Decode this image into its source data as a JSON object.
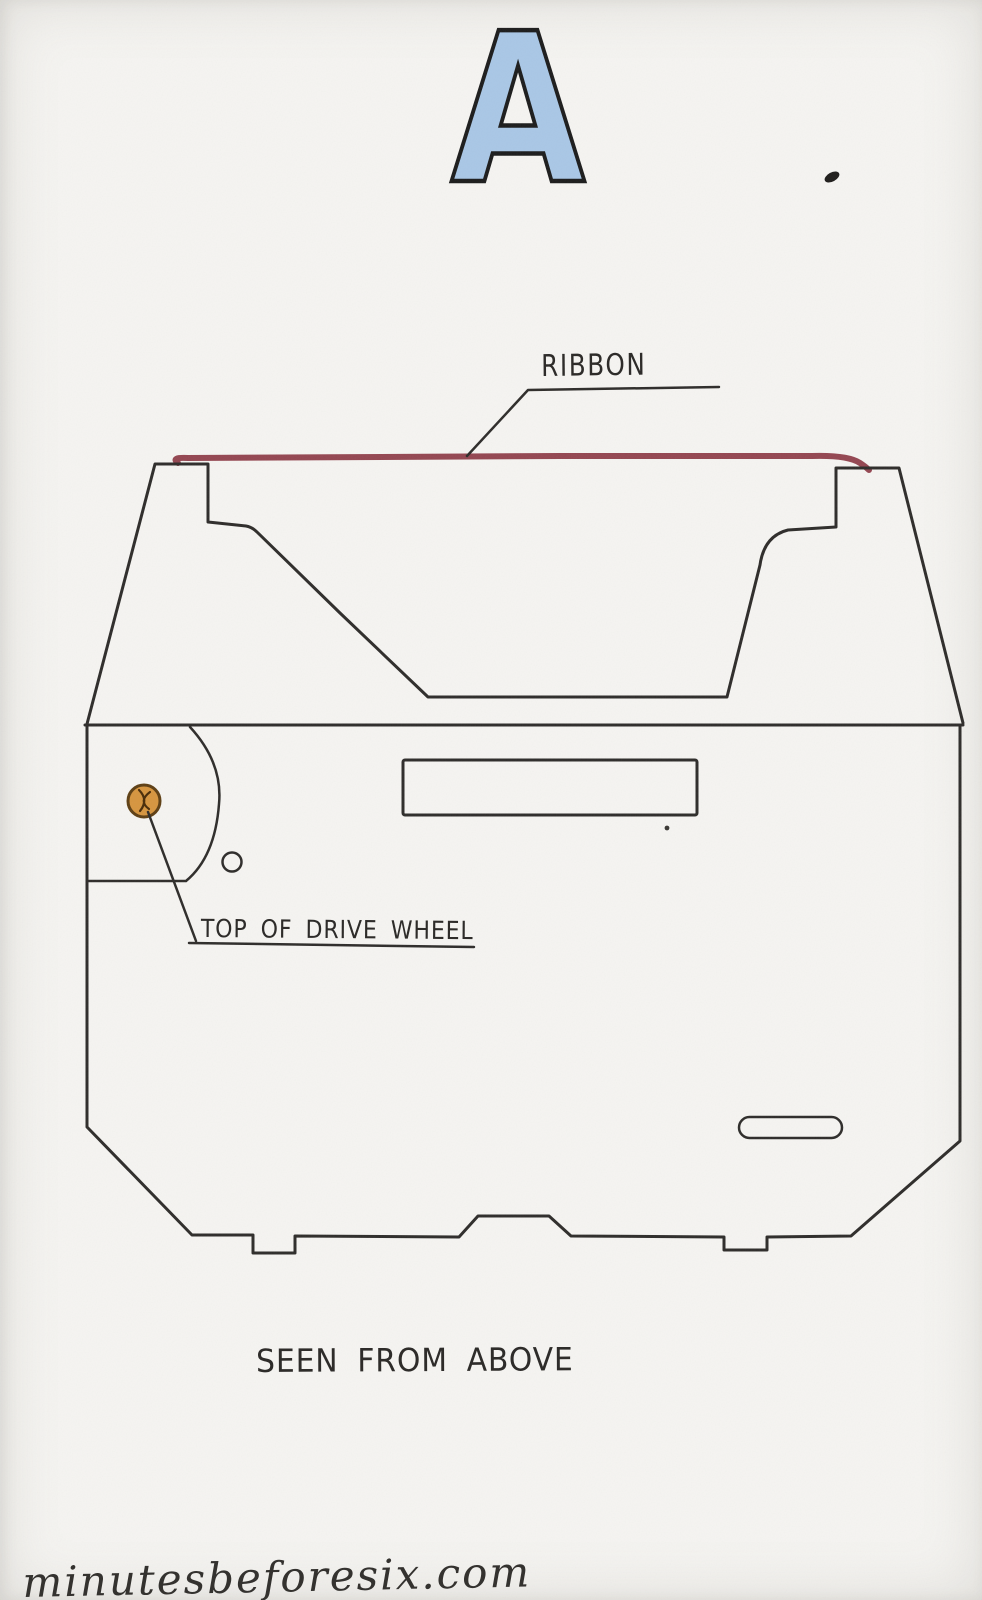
{
  "figure": {
    "letter": "A"
  },
  "annotations": {
    "ribbon_label": "RIBBON",
    "drive_wheel_label": "TOP OF DRIVE WHEEL",
    "caption": "SEEN FROM ABOVE",
    "watermark": "minutesbeforesix.com"
  },
  "diagram": {
    "type": "hand-drawn sketch",
    "subject": "typewriter ribbon cartridge, top view",
    "parts": [
      "ribbon",
      "drive wheel",
      "cartridge shell",
      "slot",
      "pill slot",
      "ink blot"
    ]
  },
  "colors": {
    "paper": "#f5f4f1",
    "ink": "#2e2c2a",
    "ribbon_red": "#8e3c48",
    "wheel_fill": "#d6953f",
    "wheel_rim": "#5e3f14",
    "letter_blue": "#a9c7e6"
  }
}
